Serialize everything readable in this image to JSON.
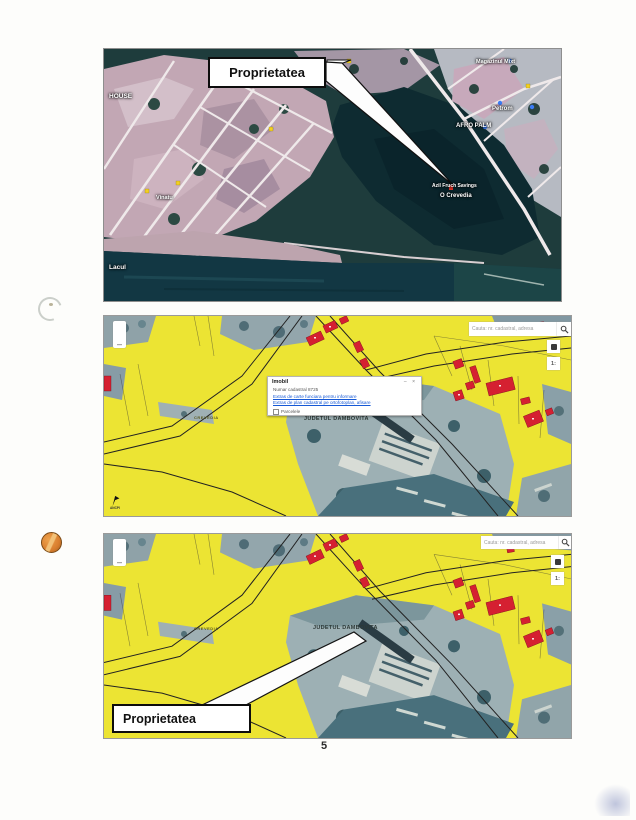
{
  "page": {
    "number": "5"
  },
  "aerial_map": {
    "callout_label": "Proprietatea",
    "labels": {
      "house": "HOUSE",
      "lake": "Lacul",
      "street": "Vinatu",
      "store": "Magazinul Mixt",
      "petrom": "Petrom",
      "afro": "AFRO PALM",
      "azil": "Azil Fruch Savings",
      "locality": "O Crevedia"
    }
  },
  "cadastral_map_top": {
    "zoom_out_label": "–",
    "search_placeholder": "Cauta: nr. cadastral, adresa",
    "scale_label": "1:",
    "popup": {
      "title": "Imobil",
      "minimize": "–",
      "close": "×",
      "info_line": "Numar cadastral 8725",
      "link_1": "Extras de carte funciara pentru informare",
      "link_2": "Extras de plan cadastral pe ortofotoplan, afisare",
      "footer": "Parcelele"
    },
    "labels": {
      "commune": "CREVEDIA",
      "county": "JUDETUL DAMBOVITA"
    },
    "logo_text": "ANCPI"
  },
  "cadastral_map_bottom": {
    "zoom_out_label": "–",
    "search_placeholder": "Cauta: nr. cadastral, adresa",
    "scale_label": "1:",
    "labels": {
      "commune": "CREVEDIA",
      "county": "JUDETUL DAMBOVITA"
    },
    "callout_label": "Proprietatea"
  }
}
